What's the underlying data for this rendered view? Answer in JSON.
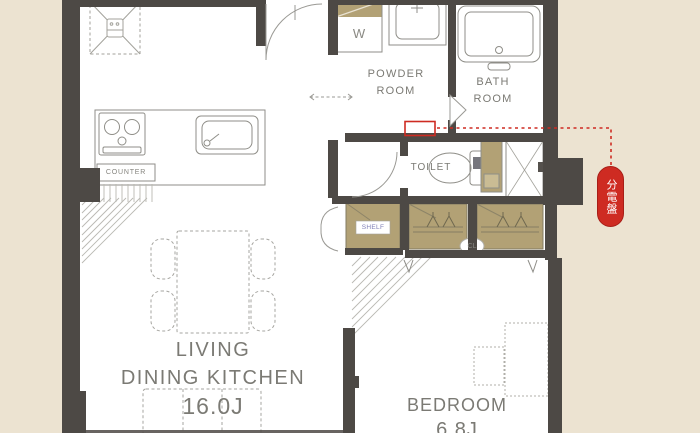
{
  "floor_plan": {
    "rooms": {
      "ldk": {
        "line1": "LIVING",
        "line2": "DINING KITCHEN",
        "size": "16.0J"
      },
      "bedroom": {
        "name": "BEDROOM",
        "size": "6.8J"
      },
      "powder": {
        "line1": "POWDER",
        "line2": "ROOM"
      },
      "bath": {
        "line1": "BATH",
        "line2": "ROOM"
      },
      "toilet": {
        "name": "TOILET"
      }
    },
    "labels": {
      "washer": "W",
      "counter": "COUNTER",
      "shelf": "SHELF",
      "closet": "CL",
      "distribution_board": "分電盤"
    },
    "colors": {
      "background": "#ece3d1",
      "wall": "#4d4945",
      "closet_fill": "#b2a175",
      "accent_red": "#ce2b22",
      "text_gray": "#7b7a74"
    }
  }
}
